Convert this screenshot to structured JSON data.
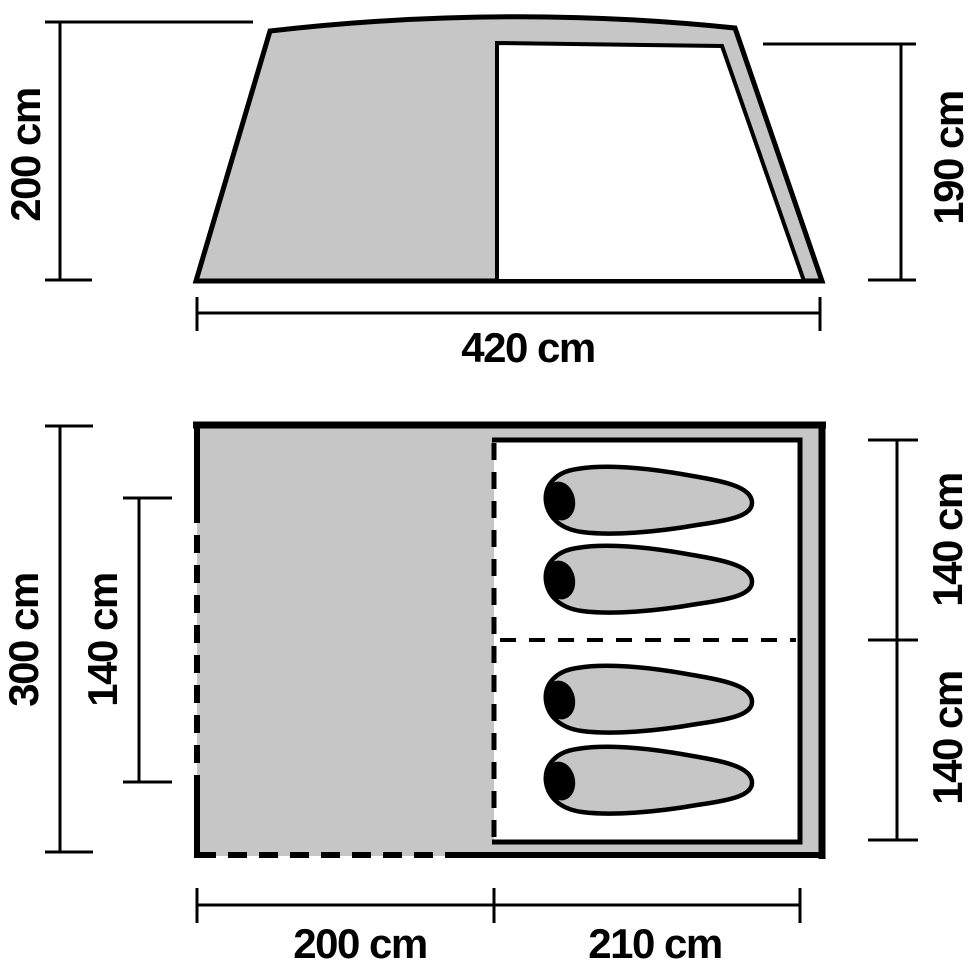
{
  "diagram_title": "Tent dimension diagram (side view and floor plan)",
  "colors": {
    "tent_gray": "#c6c6c6",
    "outline": "#000000",
    "background": "#ffffff"
  },
  "side_view": {
    "left_height": "200 cm",
    "right_height": "190 cm",
    "total_width": "420 cm"
  },
  "floor_plan": {
    "total_depth": "300 cm",
    "door_opening": "140 cm",
    "cabin_top": "140 cm",
    "cabin_bottom": "140 cm",
    "vestibule_width": "200 cm",
    "cabin_width": "210 cm",
    "sleeping_bag_count": 4
  }
}
